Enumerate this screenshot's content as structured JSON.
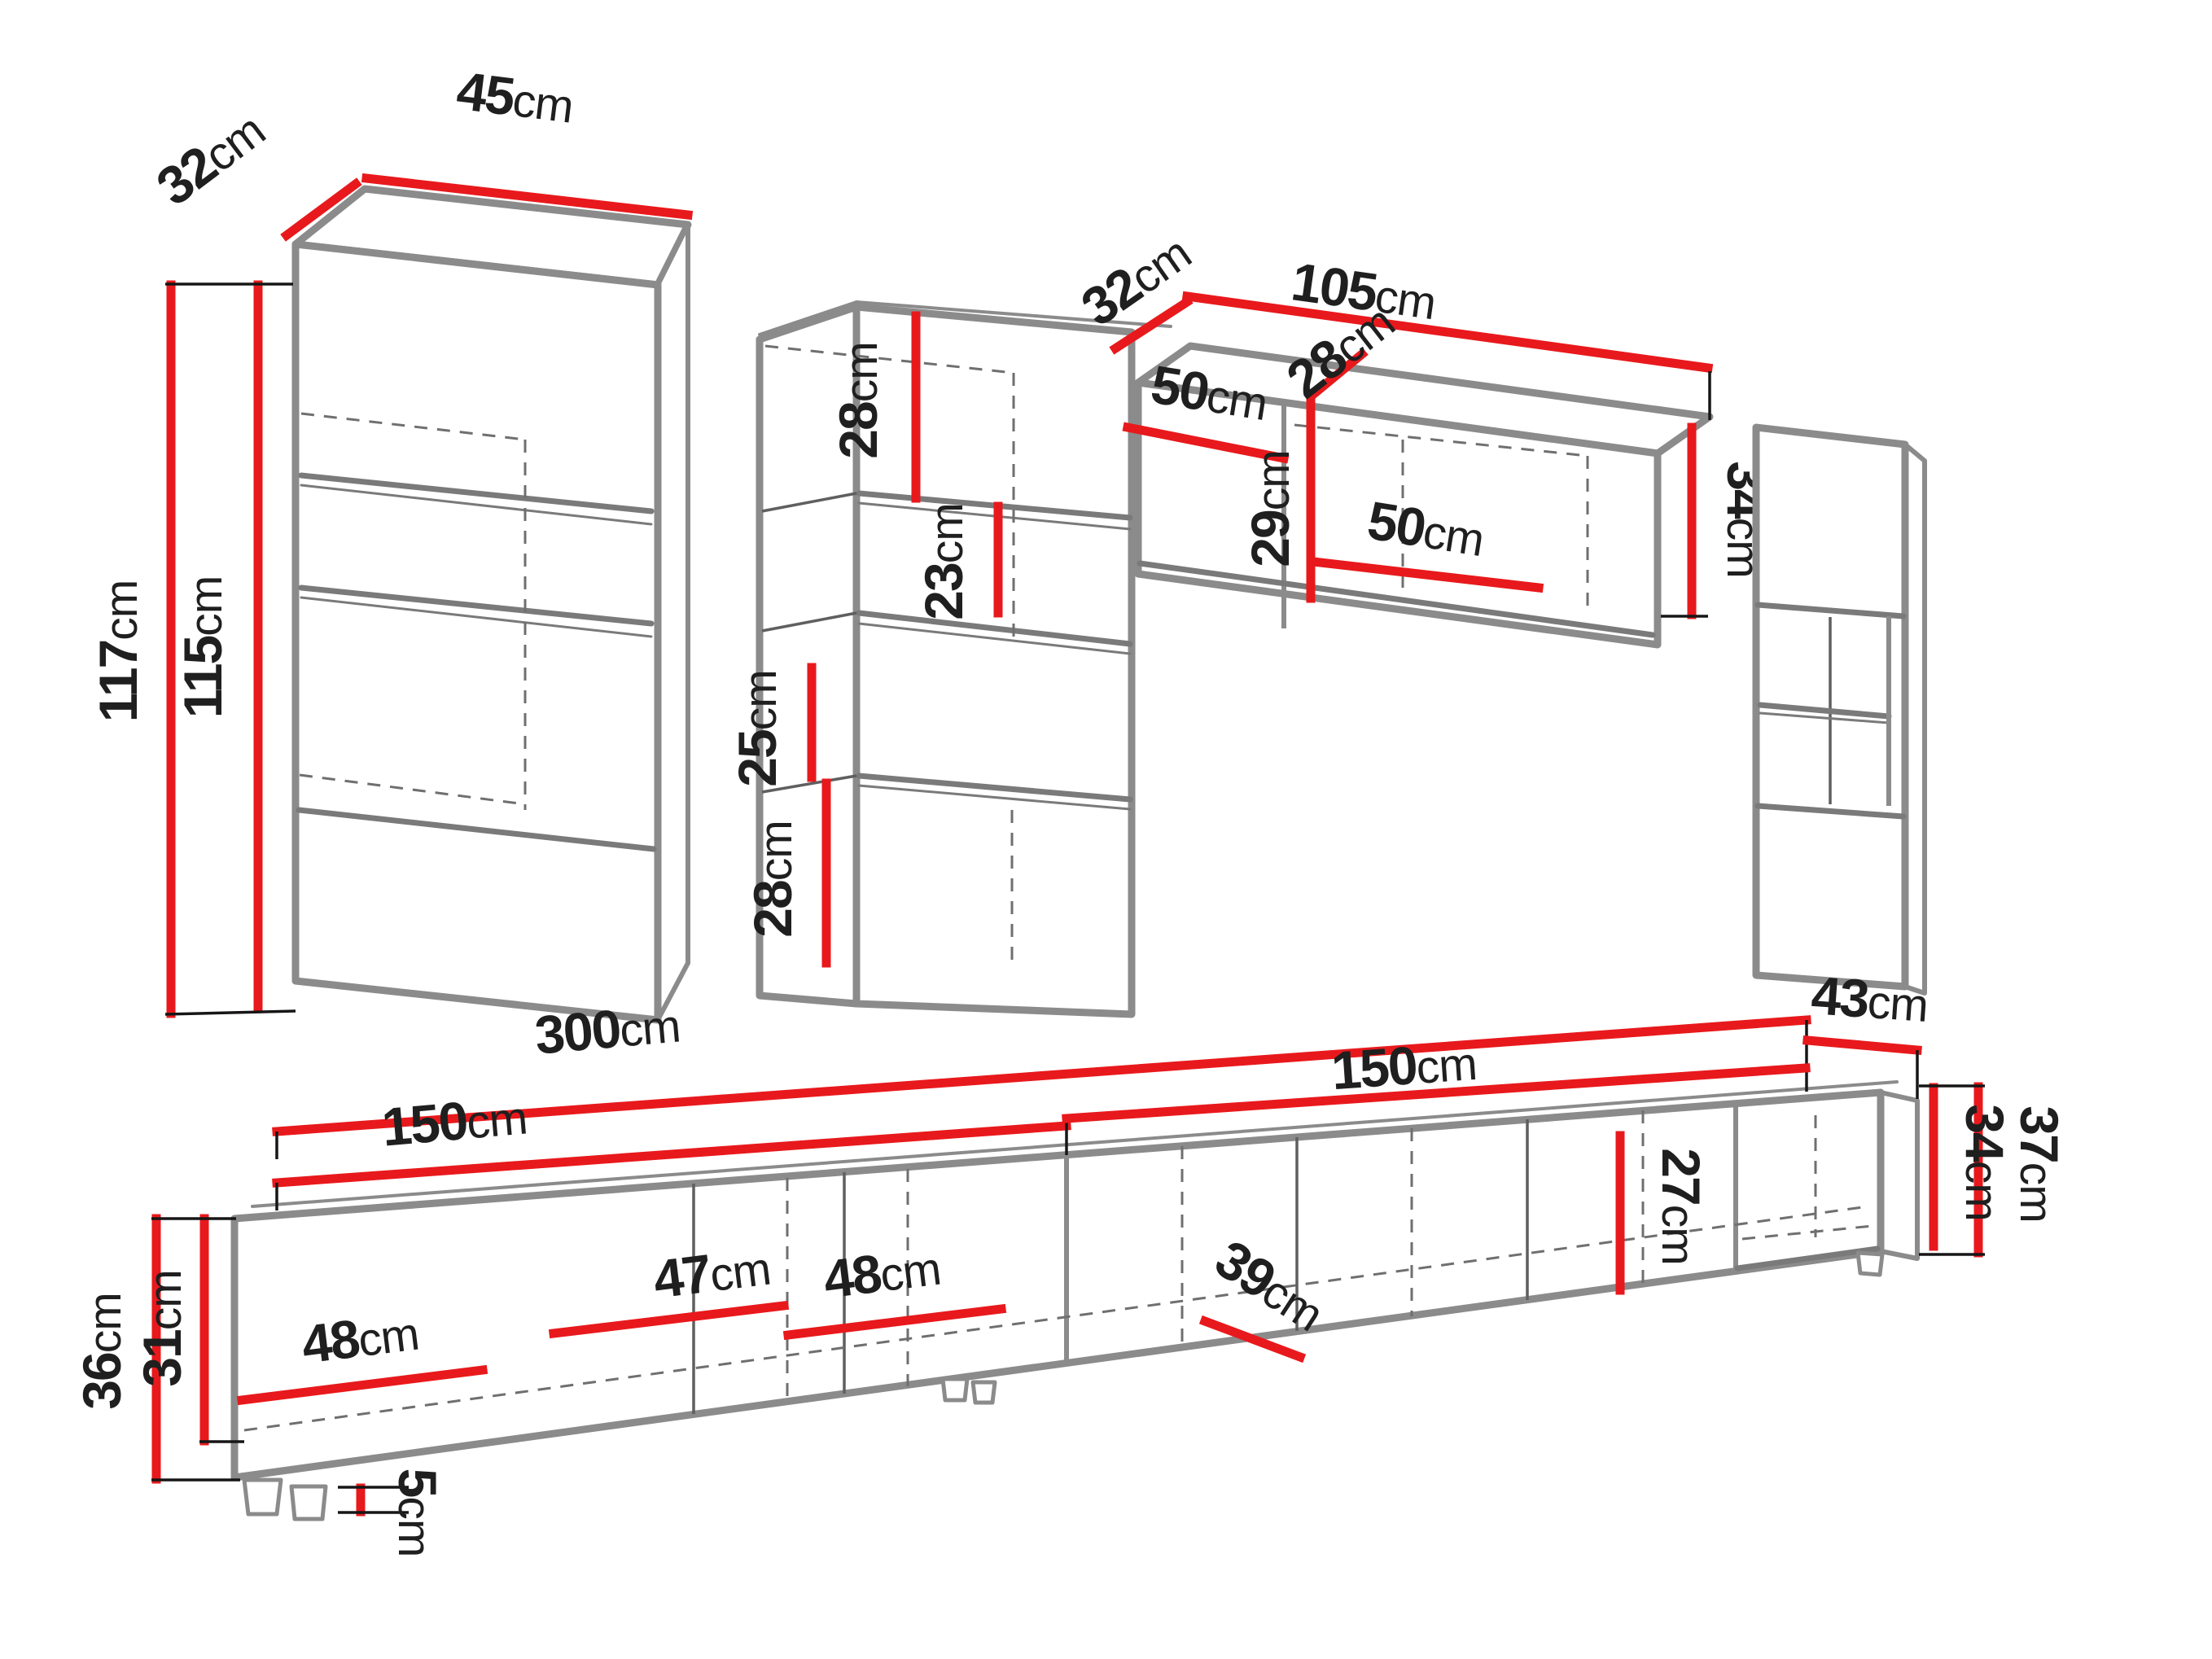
{
  "diagram": {
    "type": "furniture-dimension-diagram",
    "subject": "living-room wall unit set with TV stand",
    "units_of_measure": "cm"
  },
  "colors": {
    "dimension_line": "#e8191c",
    "cabinet_outline": "#8b8b8b",
    "label_text": "#1f1f1f",
    "background": "#ffffff"
  },
  "dims": {
    "a_depth": {
      "v": "32",
      "u": "cm"
    },
    "a_width": {
      "v": "45",
      "u": "cm"
    },
    "a_height_outer": {
      "v": "117",
      "u": "cm"
    },
    "a_height_inner": {
      "v": "115",
      "u": "cm"
    },
    "b_top_section": {
      "v": "28",
      "u": "cm"
    },
    "b_shelf_gap_upper": {
      "v": "23",
      "u": "cm"
    },
    "b_shelf_gap_lower": {
      "v": "25",
      "u": "cm"
    },
    "b_bottom_section": {
      "v": "28",
      "u": "cm"
    },
    "c_depth": {
      "v": "32",
      "u": "cm"
    },
    "c_width": {
      "v": "105",
      "u": "cm"
    },
    "c_left_compartment": {
      "v": "50",
      "u": "cm"
    },
    "c_inner_depth": {
      "v": "28",
      "u": "cm"
    },
    "c_inner_height": {
      "v": "29",
      "u": "cm"
    },
    "c_right_compartment": {
      "v": "50",
      "u": "cm"
    },
    "c_end_height": {
      "v": "34",
      "u": "cm"
    },
    "e_total_width": {
      "v": "300",
      "u": "cm"
    },
    "e_left_half": {
      "v": "150",
      "u": "cm"
    },
    "e_right_half": {
      "v": "150",
      "u": "cm"
    },
    "e_depth": {
      "v": "43",
      "u": "cm"
    },
    "e_left_height_outer": {
      "v": "36",
      "u": "cm"
    },
    "e_left_height_inner": {
      "v": "31",
      "u": "cm"
    },
    "e_right_height_outer": {
      "v": "37",
      "u": "cm"
    },
    "e_right_height_inner": {
      "v": "34",
      "u": "cm"
    },
    "e_inner_height": {
      "v": "27",
      "u": "cm"
    },
    "e_comp1_width": {
      "v": "48",
      "u": "cm"
    },
    "e_comp2_width": {
      "v": "47",
      "u": "cm"
    },
    "e_comp3_width": {
      "v": "48",
      "u": "cm"
    },
    "e_comp4_depth": {
      "v": "39",
      "u": "cm"
    },
    "e_leg_height": {
      "v": "5",
      "u": "cm"
    }
  }
}
